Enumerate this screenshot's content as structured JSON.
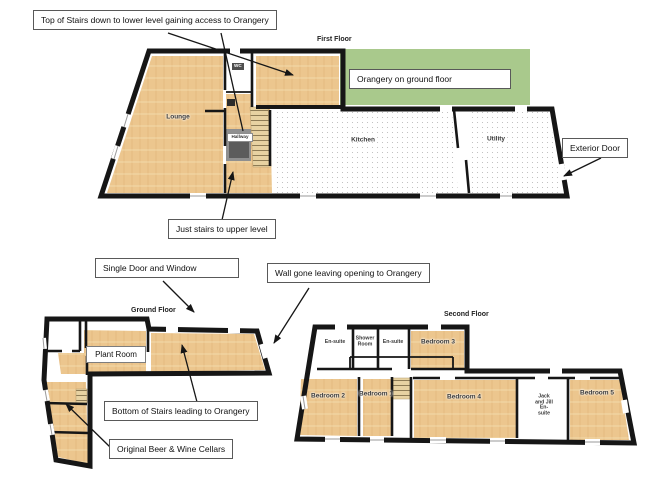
{
  "colors": {
    "wood": "#ecc68e",
    "orangery_green": "#a9c98c",
    "wall": "#161616",
    "dot_gray": "#b3b3b3"
  },
  "floors": {
    "first": {
      "title": "First Floor",
      "rooms": {
        "lounge": "Lounge",
        "wc": "WC",
        "hallway": "Hallway",
        "kitchen": "Kitchen",
        "utility": "Utility"
      }
    },
    "ground": {
      "title": "Ground Floor",
      "rooms": {
        "plant_room": "Plant Room"
      }
    },
    "second": {
      "title": "Second Floor",
      "rooms": {
        "ensuite_1": "En-suite",
        "shower_room": "Shower Room",
        "ensuite_2": "En-suite",
        "bedroom_3": "Bedroom 3",
        "bedroom_2": "Bedroom 2",
        "bedroom_1": "Bedroom 1",
        "bedroom_4": "Bedroom 4",
        "jack_and_jill": "Jack and Jill En-suite",
        "bedroom_5": "Bedroom 5"
      }
    }
  },
  "callouts": {
    "top_of_stairs": "Top of Stairs down to lower level gaining access to Orangery",
    "orangery": "Orangery on ground floor",
    "exterior_door": "Exterior Door",
    "just_stairs": "Just stairs to upper level",
    "single_door_window": "Single Door and Window",
    "wall_gone": "Wall gone leaving opening to Orangery",
    "bottom_of_stairs": "Bottom of Stairs leading to Orangery",
    "cellars": "Original Beer & Wine Cellars"
  }
}
